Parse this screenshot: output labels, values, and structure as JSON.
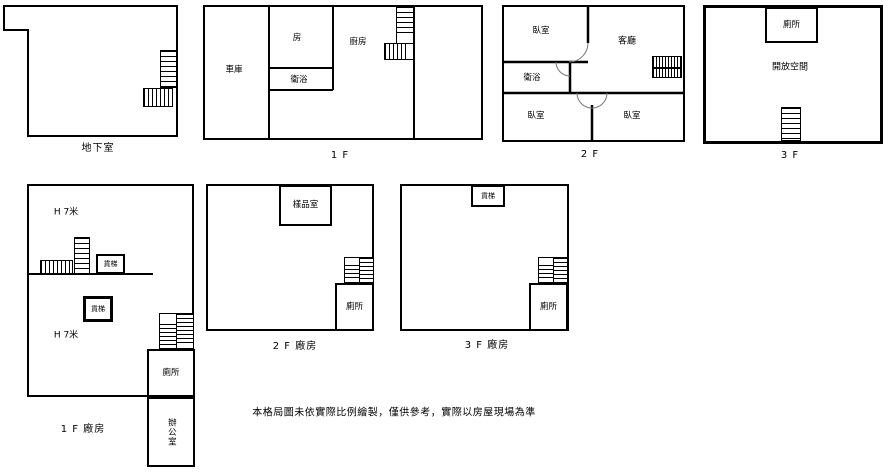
{
  "colors": {
    "wall": "#000000",
    "background": "#ffffff",
    "door_arc": "#777777"
  },
  "plans": {
    "basement": {
      "floor_label": "地下室"
    },
    "f1": {
      "floor_label": "1 F",
      "rooms": {
        "garage": "車庫",
        "room": "房",
        "bath": "衛浴",
        "kitchen": "廚房"
      }
    },
    "f2": {
      "floor_label": "2 F",
      "rooms": {
        "bedroom_top": "臥室",
        "living_room": "客廳",
        "bath": "衛浴",
        "bedroom_bottom_left": "臥室",
        "bedroom_bottom_right": "臥室"
      }
    },
    "f3": {
      "floor_label": "3 F",
      "rooms": {
        "toilet": "廁所",
        "open_space": "開放空間"
      }
    },
    "factory_1f": {
      "floor_label": "1 F 廠房",
      "height_label_top": "H 7米",
      "height_label_bottom": "H 7米",
      "rooms": {
        "freight_elevator_upper": "貨梯",
        "freight_elevator_lower": "貨梯",
        "toilet": "廁所",
        "office": "辦公室"
      }
    },
    "factory_2f": {
      "floor_label": "2 F 廠房",
      "rooms": {
        "sample_room": "樣品室",
        "toilet": "廁所"
      }
    },
    "factory_3f": {
      "floor_label": "3 F 廠房",
      "rooms": {
        "freight_elevator": "貨梯",
        "toilet": "廁所"
      }
    }
  },
  "disclaimer": "本格局圖未依實際比例繪製，僅供參考，實際以房屋現場為準"
}
